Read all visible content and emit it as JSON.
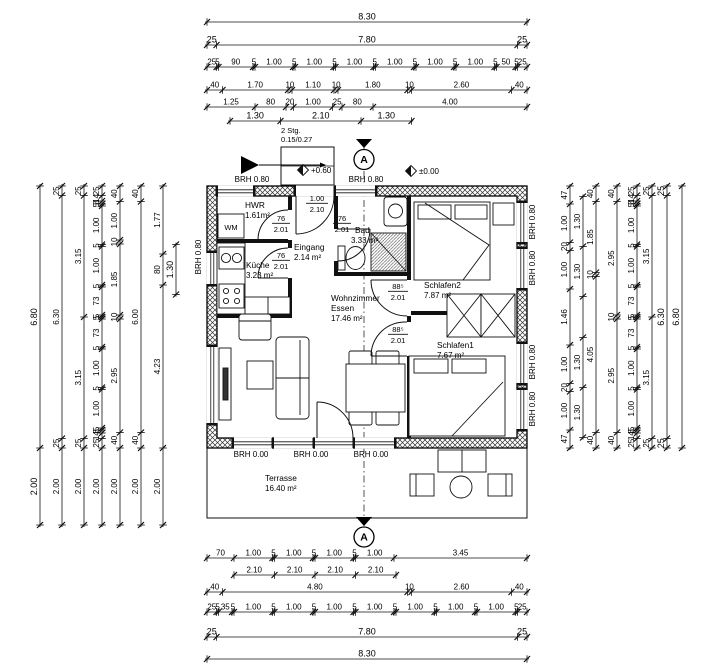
{
  "section_marker": "A",
  "stairs_note": {
    "line1": "2 Stg.",
    "line2": "0.15/0.27"
  },
  "level_markers": [
    "+0.60",
    "±0.00"
  ],
  "appliance_labels": [
    "WM"
  ],
  "brh_labels": {
    "top": [
      "BRH 0.80",
      "BRH 0.80"
    ],
    "left": [
      "BRH 0.80"
    ],
    "right": [
      "BRH 0.80",
      "BRH 0.80",
      "BRH 0.80",
      "BRH 0.80"
    ],
    "bottom": [
      "BRH 0.00",
      "BRH 0.00",
      "BRH 0.00"
    ]
  },
  "rooms": [
    {
      "id": "hwr",
      "name": "HWR",
      "area": "1.61m²"
    },
    {
      "id": "eingang",
      "name": "Eingang",
      "area": "2.14 m²"
    },
    {
      "id": "kueche",
      "name": "Küche",
      "area": "3.23 m²"
    },
    {
      "id": "bad",
      "name": "Bad",
      "area": "3.33 m²"
    },
    {
      "id": "schlafen2",
      "name": "Schlafen2",
      "area": "7.87 m²"
    },
    {
      "id": "schlafen1",
      "name": "Schlafen1",
      "area": "7.67 m²"
    },
    {
      "id": "wohnzimmer",
      "name": "Wohnzimmer",
      "name2": "Essen",
      "area": "17.46 m²"
    },
    {
      "id": "terrasse",
      "name": "Terrasse",
      "area": "16.40 m²"
    }
  ],
  "door_labels": [
    {
      "id": "entrance-door",
      "w": "1.00",
      "h": "2.10"
    },
    {
      "id": "hwr-door",
      "w": "76",
      "h": "2.01"
    },
    {
      "id": "kueche-door",
      "w": "76",
      "h": "2.01"
    },
    {
      "id": "bad-door",
      "w": "76",
      "h": "2.01"
    },
    {
      "id": "schlafen2-door",
      "w": "88⁵",
      "h": "2.01"
    },
    {
      "id": "schlafen1-door",
      "w": "88⁵",
      "h": "2.01"
    }
  ],
  "dims": {
    "top": [
      [
        "8.30"
      ],
      [
        "25",
        "7.80",
        "25"
      ],
      [
        "25",
        "5",
        "90",
        "5",
        "1.00",
        "5",
        "1.00",
        "5",
        "1.00",
        "5",
        "1.00",
        "5",
        "1.00",
        "5",
        "1.00",
        "5",
        "50",
        "5",
        "25"
      ],
      [
        "40",
        "1.70",
        "10",
        "1.10",
        "10",
        "1.80",
        "10",
        "2.60",
        "40"
      ],
      [
        "1.25",
        "80",
        "20",
        "1.00",
        "25",
        "80",
        "4.00"
      ],
      [
        {
          "gap": 60
        },
        "1.30",
        "2.10",
        "1.30",
        {
          "gap": 300
        }
      ]
    ],
    "bottom": [
      [
        "70",
        "1.00",
        "5",
        "1.00",
        "5",
        "1.00",
        "5",
        "1.00",
        "3.45"
      ],
      [
        {
          "gap": 70
        },
        {
          "v": "2.10",
          "w": 105
        },
        {
          "v": "2.10",
          "w": 105
        },
        {
          "v": "2.10",
          "w": 105
        },
        {
          "v": "2.10",
          "w": 105
        },
        {
          "gap": 340
        }
      ],
      [
        "40",
        "4.80",
        "10",
        "2.60",
        "40"
      ],
      [
        "25",
        "5",
        "35",
        "5",
        "1.00",
        "5",
        "1.00",
        "5",
        "1.00",
        "5",
        "1.00",
        "5",
        "1.00",
        "5",
        "1.00",
        "5",
        "1.00",
        "5",
        "25"
      ],
      [
        "25",
        "7.80",
        "25"
      ],
      [
        "8.30"
      ]
    ],
    "left": [
      [
        "6.80",
        "2.00"
      ],
      [
        "25",
        "6.30",
        "25",
        "2.00"
      ],
      [
        "25",
        "3.15",
        "3.15",
        "25",
        "2.00"
      ],
      [
        "25",
        "14",
        "8",
        "5",
        "1.00",
        "5",
        "1.00",
        "5",
        "73",
        "5",
        "5",
        "73",
        "5",
        "1.00",
        "5",
        "1.00",
        "5",
        "8",
        "14",
        "25",
        "2.00"
      ],
      [
        "40",
        "1.00",
        "10",
        "1.85",
        "10",
        "2.95",
        "40",
        "2.00"
      ],
      [
        "40",
        "6.00",
        "40",
        "2.00"
      ],
      [
        "1.77",
        "80",
        "4.23",
        "2.00"
      ],
      [
        {
          "gap": 152
        },
        "1.30",
        {
          "gap": 398
        }
      ]
    ],
    "right": [
      [
        "47",
        "1.00",
        "20",
        "1.00",
        "1.46",
        "1.00",
        "20",
        "1.00",
        "47"
      ],
      [
        {
          "gap": 27
        },
        "1.30",
        "1.30",
        {
          "gap": 106
        },
        "1.30",
        "1.30",
        {
          "gap": 27
        }
      ],
      [
        "40",
        "1.85",
        "10",
        "4.05",
        "40"
      ],
      [
        "40",
        "2.95",
        "10",
        "2.95",
        "40"
      ],
      [
        "25",
        "14",
        "8",
        "5",
        "1.00",
        "5",
        "1.00",
        "5",
        "73",
        "5",
        "5",
        "73",
        "5",
        "1.00",
        "5",
        "1.00",
        "5",
        "8",
        "14",
        "25"
      ],
      [
        "25",
        "3.15",
        "3.15",
        "25"
      ],
      [
        "25",
        "6.30",
        "25"
      ],
      [
        "6.80"
      ]
    ]
  }
}
